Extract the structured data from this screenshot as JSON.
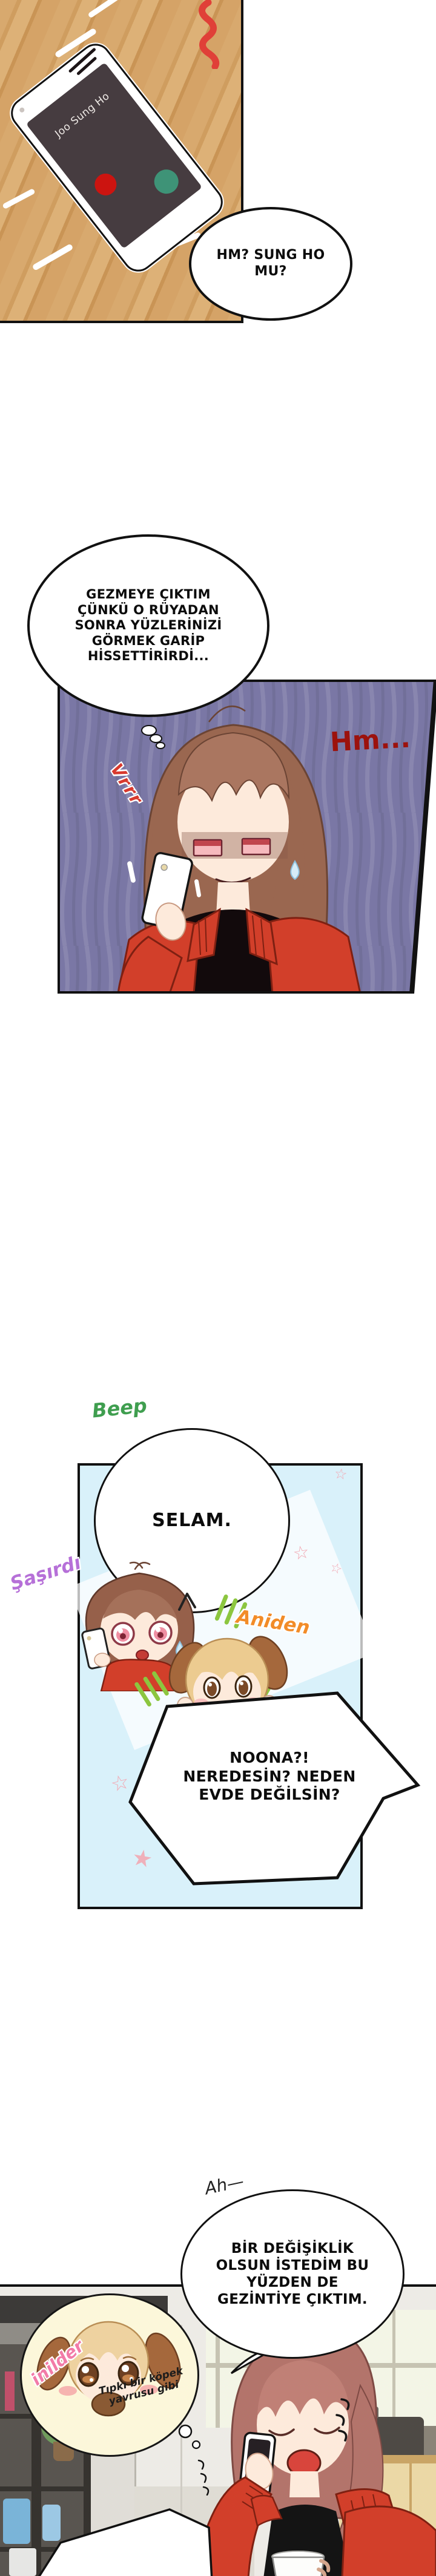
{
  "colors": {
    "wood": "#d2a166",
    "panel2_bg": "#7a77a5",
    "panel3_bg": "#d9f1fa",
    "panel4_wall": "#edebe6",
    "jacket_red": "#d23f2a",
    "decline_red": "#cc1410",
    "answer_green": "#3e9377",
    "star_pink": "#f2a9b4",
    "hm_red": "#9c120d",
    "vrrr_red": "#d8392e",
    "beep_green": "#3f9e4f",
    "sasirdi_purple": "#b670d8",
    "aniden_orange": "#f28c28",
    "inilder_pink": "#f27ba8",
    "thought_bubble_yellow": "#fcf7da"
  },
  "panel1": {
    "phone": {
      "caller_name": "Joo Sung Ho"
    },
    "speech_bubble": "HM? SUNG HO\nMU?"
  },
  "panel2": {
    "speech_bubble": "GEZMEYE ÇIKTIM\nÇÜNKÜ O RÜYADAN\nSONRA YÜZLERİNİZİ\nGÖRMEK GARİP\nHİSSETTİRİRDİ...",
    "sfx_hm": "Hm...",
    "sfx_vibrate": "Vrrr"
  },
  "between_panels_2_3": {
    "sfx_beep": "Beep"
  },
  "panel3": {
    "speech_bubble_selam": "SELAM.",
    "sfx_surprised": "Şaşırdı",
    "sfx_suddenly": "Aniden",
    "speech_bubble_noona": "NOONA?!\nNEREDESİN? NEDEN\nEVDE DEĞİLSİN?"
  },
  "between_panels_3_4": {
    "sfx_ah": "Ah—"
  },
  "panel4": {
    "speech_bubble": "BİR DEĞİŞİKLİK\nOLSUN İSTEDİM BU\nYÜZDEN DE\nGEZİNTİYE ÇIKTIM.",
    "thought_bubble": {
      "sfx_whimper": "inilder",
      "caption": "Tıpkı bir köpek\nyavrusu gibi"
    }
  }
}
